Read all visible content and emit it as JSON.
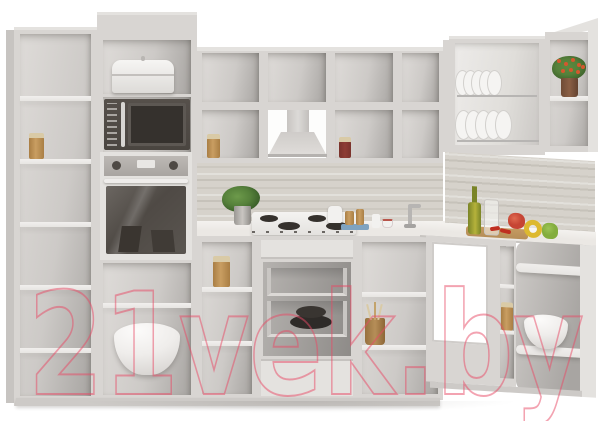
{
  "watermark": {
    "text": "21vek.by",
    "opacity": "0.5"
  },
  "palette": {
    "bg": "#ffffff",
    "face": "#d8d5d2",
    "faceLight": "#e4e2df",
    "sidePanel": "#c7c4c1",
    "interiorLight": "#dedbd8",
    "interior": "#cdcac7",
    "interiorDark": "#a8a5a2",
    "interiorDeep": "#8e8b88",
    "shelf": "#e7e5e2",
    "splash": "#d6d2cb",
    "counter": "#ebe8e4",
    "counterEdge": "#c8c5c1",
    "plinth": "#cdcac7",
    "applianceDark": "#4a4540",
    "applianceDeep": "#35312d",
    "steel": "#a9a5a1",
    "glass1": "#6b6661",
    "glass2": "#4f4a45",
    "whiteItem": "#f2f1ef",
    "amber": "#c99e62",
    "amberDeep": "#a97e44",
    "cork": "#d9caa6",
    "redJar": "#8e3d34",
    "leaf": "#55803a",
    "leafDark": "#3c612a",
    "flower": "#d4582e",
    "terracotta": "#8a5f45",
    "wood": "#b68e58",
    "oil": "#b5b23b",
    "oilDark": "#7a8427",
    "pepperRed": "#c64534",
    "pepperYellow": "#ddb92f",
    "pepperGreen": "#83ad3d",
    "chili": "#bf2f21",
    "blueDish": "#7fa3c0",
    "chrome": "#b7b5b3",
    "watermark": "#e84a66"
  },
  "scene": {
    "kind": "product-photo",
    "subject": "corner kitchen cabinet set, light grey, open carcasses",
    "objects": [
      "tall-open-shelf-unit",
      "oven-housing-column",
      "bread-bin",
      "microwave-oven",
      "built-in-oven",
      "mixing-bowl",
      "upper-wall-shelves",
      "spice-jars",
      "range-hood",
      "wood-backsplash",
      "countertop",
      "herb-plant",
      "gas-cooktop",
      "milk-jug",
      "serving-tray-with-bottles",
      "corner-faucet",
      "base-open-shelves",
      "storage-jar",
      "drawer-unit-with-metabox-drawers",
      "black-cookware",
      "utensil-crock",
      "dish-drainer-cabinet",
      "plates",
      "corner-display-shelf",
      "flowering-pot-plant",
      "corner-sink-cabinet",
      "rounded-end-shelf-unit",
      "white-serving-bowl",
      "olive-oil-bottle",
      "glass-jar",
      "cutting-board",
      "chili-peppers",
      "bell-peppers"
    ]
  }
}
